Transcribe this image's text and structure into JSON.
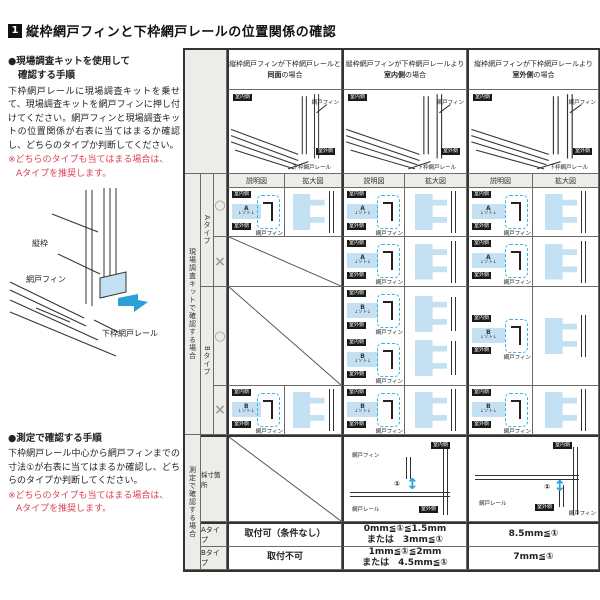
{
  "title": {
    "badge": "1",
    "text": "縦枠網戸フィンと下枠網戸レールの位置関係の確認"
  },
  "kit_procedure": {
    "heading1": "●現場調査キットを使用して",
    "heading2": "確認する手順",
    "body": "下枠網戸レールに現場調査キットを乗せて、現場調査キットを網戸フィンに押し付けてください。網戸フィンと現場調査キットの位置関係が右表に当てはまるか確認し、どちらのタイプか判断してください。",
    "note1": "※どちらのタイプも当てはまる場合は、",
    "note2": "Aタイプを推奨します。"
  },
  "left_diagram": {
    "frame": "縦枠",
    "fin": "網戸フィン",
    "rail": "下枠網戸レール"
  },
  "measure_procedure": {
    "heading": "●測定で確認する手順",
    "body": "下枠網戸レール中心から網戸フィンまでの寸法①が右表に当てはまるか確認し、どちらのタイプか判断してください。",
    "note1": "※どちらのタイプも当てはまる場合は、",
    "note2": "Aタイプを推奨します。"
  },
  "labels": {
    "indoor": "室内側",
    "outdoor": "室外側",
    "fin": "網戸フィン",
    "rail": "下枠網戸レール",
    "screen_rail": "網戸レール",
    "soto": "↓ソト↓",
    "dim": "①",
    "explain": "説明図",
    "enlarge": "拡大図",
    "ok": "○",
    "ng": "×",
    "kit_a": "A",
    "kit_b": "B"
  },
  "col_headers": [
    {
      "line1": "縦枠網戸フィンが下枠網戸レールと",
      "bold": "同面",
      "rest": "の場合"
    },
    {
      "line1": "縦枠網戸フィンが下枠網戸レールより",
      "bold": "室内側",
      "rest": "の場合"
    },
    {
      "line1": "縦枠網戸フィンが下枠網戸レールより",
      "bold": "室外側",
      "rest": "の場合"
    }
  ],
  "strips": {
    "kit_group": "現場調査キットで確認する場合",
    "measure_group": "測定で確認する場合",
    "type_a": "Aタイプ",
    "type_b": "Bタイプ",
    "measure_row": "採寸箇所"
  },
  "results": {
    "a": {
      "label": "Aタイプ",
      "flush": "取付可（条件なし）",
      "indoor1": "0mm≦①≦1.5mm",
      "indoor2": "または　3mm≦①",
      "outdoor": "8.5mm≦①"
    },
    "b": {
      "label": "Bタイプ",
      "flush": "取付不可",
      "indoor1": "1mm≦①≦2mm",
      "indoor2": "または　4.5mm≦①",
      "outdoor": "7mm≦①"
    }
  }
}
